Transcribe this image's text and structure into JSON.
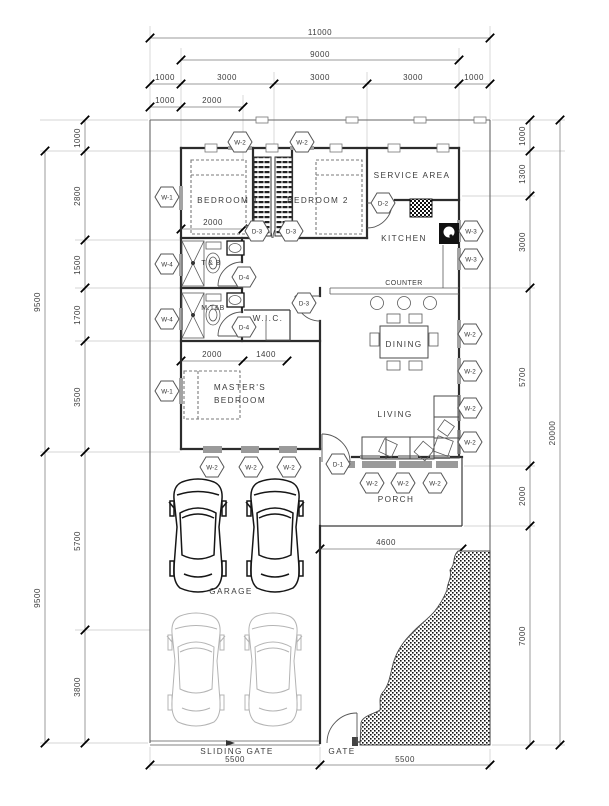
{
  "plan": {
    "colors": {
      "ink": "#2c2c2c",
      "background": "#ffffff",
      "glazing": "#a3a3a3"
    },
    "rooms": {
      "bedroom1": "BEDROOM 1",
      "bedroom2": "BEDROOM 2",
      "service_area": "SERVICE AREA",
      "kitchen": "KITCHEN",
      "counter": "COUNTER",
      "dining": "DINING",
      "living": "LIVING",
      "wic": "W.I.C.",
      "toilet_bath": "T & B",
      "master_toilet_bath": "M.T&B",
      "masters_bedroom_line1": "MASTER'S",
      "masters_bedroom_line2": "BEDROOM",
      "porch": "PORCH",
      "garage": "GARAGE",
      "sliding_gate": "SLIDING GATE",
      "gate": "GATE"
    },
    "dims": {
      "top": [
        "11000",
        "9000",
        "1000",
        "3000",
        "3000",
        "3000",
        "1000",
        "1000",
        "2000"
      ],
      "left": [
        "1000",
        "2800",
        "1500",
        "1700",
        "3500",
        "5700",
        "3800",
        "9500",
        "9500"
      ],
      "right": [
        "1000",
        "1300",
        "3000",
        "5700",
        "2000",
        "7000",
        "20000"
      ],
      "bottom": [
        "5500",
        "5500"
      ],
      "inner": [
        "2000",
        "2000",
        "1400",
        "4600"
      ]
    },
    "symbols": [
      "W-2",
      "W-2",
      "W-1",
      "W-4",
      "W-4",
      "W-1",
      "D-3",
      "D-3",
      "D-2",
      "D-4",
      "D-4",
      "D-3",
      "W-3",
      "W-3",
      "W-2",
      "W-2",
      "W-2",
      "W-2",
      "W-2",
      "W-2",
      "W-2",
      "D-1",
      "W-2",
      "W-2",
      "W-2"
    ]
  }
}
